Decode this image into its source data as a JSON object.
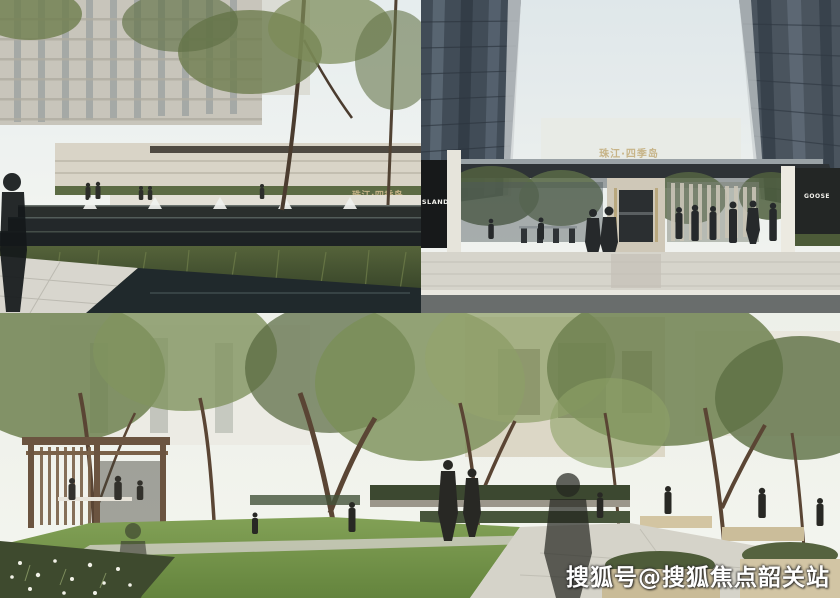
{
  "watermark": {
    "text": "搜狐号@搜狐焦点韶关站",
    "color": "#ffffff"
  },
  "panels": {
    "waterscape": {
      "description": "stepped water feature with ornamental grasses and towers",
      "sign_cn": "珠江·四季岛"
    },
    "entrance": {
      "description": "residential entrance gate between two towers",
      "roof_sign_cn": "珠江·四季岛",
      "pillar_sign_en": "ISLAND",
      "shop_sign_en": "GOOSE"
    },
    "garden": {
      "description": "courtyard garden with lawn, pergola and trees"
    }
  },
  "palette": {
    "sign_gold": "#c7b488",
    "sign_white": "#f2f1ec",
    "sky": "#e9efef",
    "tower_dark": "#45505b",
    "foliage": "#66784a",
    "lawn": "#74944c",
    "paving": "#d6d4cb",
    "water_dark": "#232c2f",
    "wood_brown": "#6b5440",
    "watermark_white": "#ffffff"
  }
}
